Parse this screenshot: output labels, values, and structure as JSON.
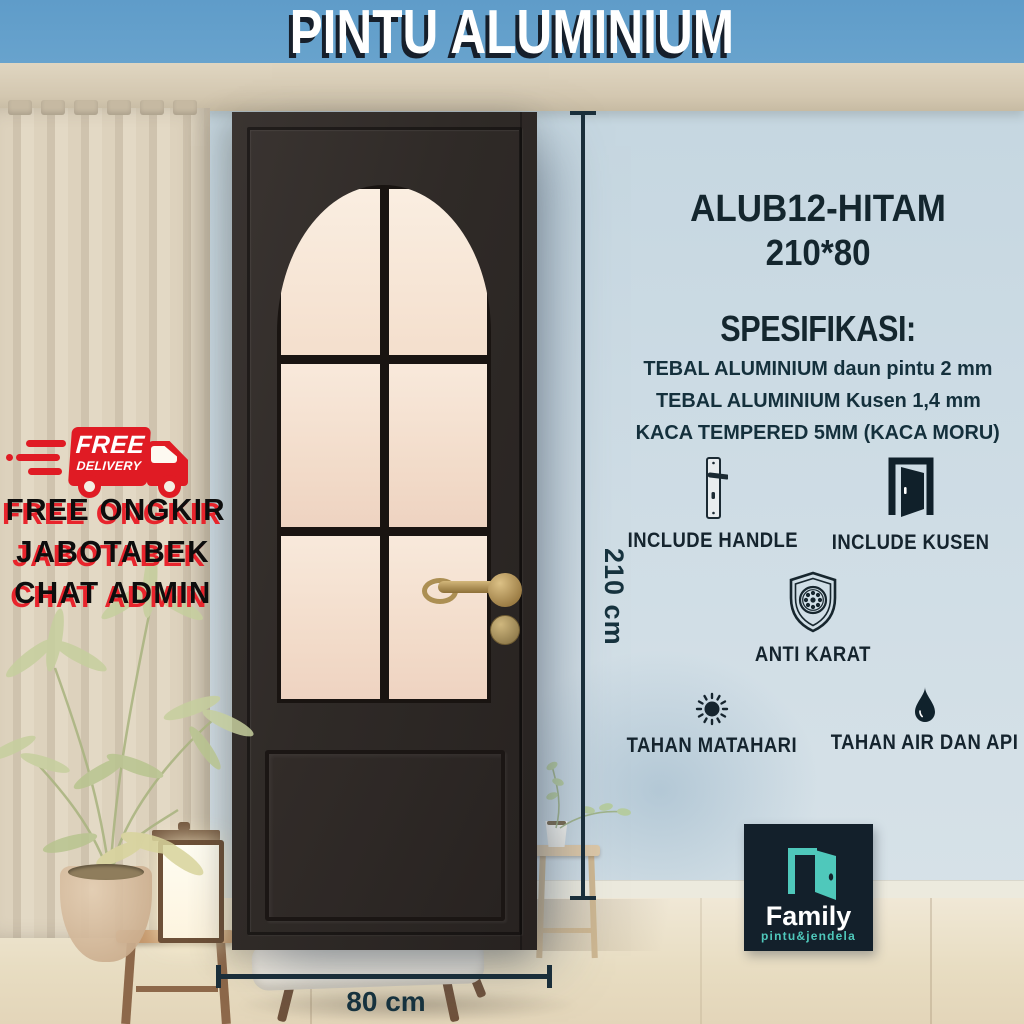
{
  "header": {
    "title": "PINTU ALUMINIUM"
  },
  "promo": {
    "badge_icon": "delivery-truck-icon",
    "badge_line1": "FREE",
    "badge_line2": "DELIVERY",
    "line1": "FREE ONGKIR",
    "line2": "JABOTABEK",
    "line3": "CHAT ADMIN"
  },
  "product": {
    "model": "ALUB12-HITAM",
    "size": "210*80",
    "spec_title": "SPESIFIKASI:",
    "specs": [
      "TEBAL ALUMINIUM daun pintu 2 mm",
      "TEBAL ALUMINIUM Kusen 1,4 mm",
      "KACA TEMPERED 5MM (KACA MORU)"
    ],
    "features": [
      {
        "icon": "door-handle-icon",
        "label": "INCLUDE HANDLE"
      },
      {
        "icon": "open-door-icon",
        "label": "INCLUDE KUSEN"
      },
      {
        "icon": "anti-rust-shield-icon",
        "label": "ANTI KARAT"
      },
      {
        "icon": "sun-icon",
        "label": "TAHAN MATAHARI"
      },
      {
        "icon": "water-drop-icon",
        "label": "TAHAN AIR DAN API"
      }
    ]
  },
  "dimensions": {
    "height_label": "210 cm",
    "width_label": "80 cm"
  },
  "brand": {
    "icon": "open-door-icon",
    "name": "Family",
    "tagline": "pintu&jendela"
  },
  "colors": {
    "header_blue": "#68a3cd",
    "wall_blue": "#ccdbe4",
    "curtain_beige": "#d8cdb7",
    "door_dark": "#2f2a27",
    "glass_cream": "#f4e0d2",
    "accent_navy": "#16262f",
    "promo_red": "#e01b24",
    "brand_teal": "#4fc8bb",
    "floor_wood": "#e8ddc2"
  }
}
